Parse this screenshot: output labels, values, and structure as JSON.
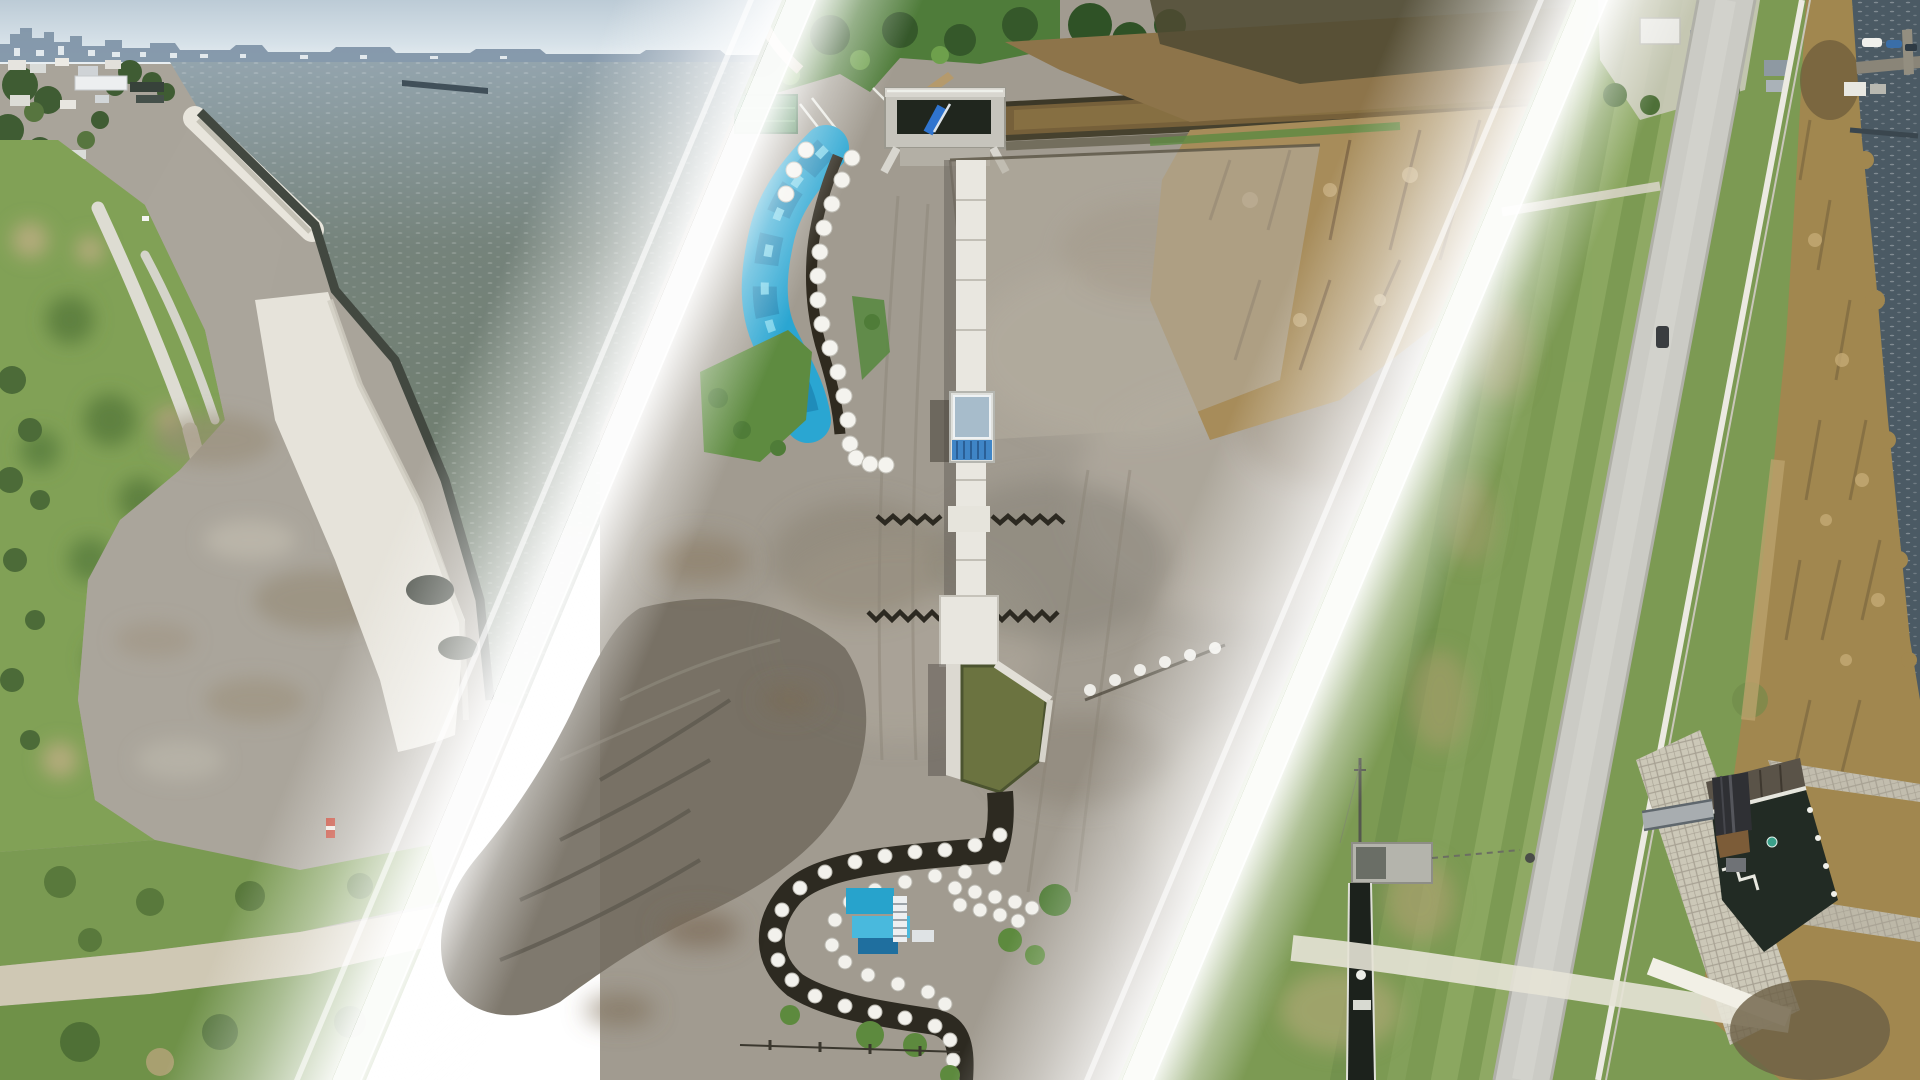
{
  "scene": {
    "type": "photo-collage",
    "title": "Aerial drone photo collage of lakeside levee and sluice construction sites",
    "no_visible_text": true,
    "layout": "three photographs separated by two parallel diagonal white gradient bands slanting toward bottom-left",
    "divider_color": "#ffffff"
  },
  "panels": {
    "left": {
      "label": "Oblique aerial photo: lakeshore levee with white riprap revetment, green farm fields and paths, town with trees, distant city skyline across gray-green water",
      "features": [
        "sky",
        "city-skyline",
        "lake-water",
        "breakwater",
        "shore-town",
        "trees",
        "green-fields",
        "farm-paths",
        "riprap-revetment",
        "gravel-works-area",
        "red-marker",
        "dirt-road",
        "bottom-grass"
      ],
      "palette": {
        "sky": "#c3d2da",
        "water": "#74816f",
        "skyline": "#7e93a6",
        "field": "#81a156",
        "revetment": "#e8e5dc",
        "gravel": "#a9a49a"
      }
    },
    "middle": {
      "label": "Top-down drone photo: drainage sluice construction site with concrete culvert, blue tarpaulin S-curve, white sandbag rows, concrete flume, stilling basin and spoil mound",
      "features": [
        "tree-line",
        "green-roof-shed",
        "concrete-culvert",
        "blue-pipe",
        "upstream-ditch",
        "reed-marsh",
        "cleared-pad",
        "blue-tarp-s-curve",
        "sandbag-rows",
        "concrete-flume",
        "gauge-house",
        "sheet-pile-rows",
        "stilling-basin",
        "dark-channel",
        "sandbag-c-curve",
        "work-tarps",
        "ladder",
        "spoil-mound",
        "grass-patches",
        "fence-line"
      ],
      "palette": {
        "dirt": "#a19b90",
        "tarp": "#2aa6d2",
        "sandbag": "#f3f2ec",
        "basin_water": "#6b7340",
        "reeds": "#a78c5a",
        "culvert_opening": "#20261e"
      }
    },
    "right": {
      "label": "Top-down aerial photo: river levee crest road with mowed grass, sluice gate building with footbridge, stone block revetment, reed marsh, boat dock and open water",
      "features": [
        "levee-road",
        "mowed-grass",
        "crest-wall",
        "reed-marsh",
        "open-water",
        "boat-dock",
        "boats",
        "waterside-buildings",
        "joining-trail",
        "car",
        "intake-mast",
        "intake-platform",
        "intake-channel",
        "sluice-building",
        "footbridge-walkway",
        "stone-revetment",
        "outlet-channel",
        "buoy",
        "white-stairs",
        "crossing-path"
      ],
      "palette": {
        "grass": "#7c9a53",
        "road": "#cbcbc5",
        "marsh": "#a1874f",
        "water": "#4b5a64",
        "roof": "#2f3034"
      }
    }
  },
  "dividers": [
    {
      "name": "divider-left",
      "angle_deg": -22.8,
      "core_top_x": 786,
      "core_bottom_x": 332,
      "style": "soft white fade-in, bright core line, fade-out"
    },
    {
      "name": "divider-right",
      "angle_deg": -22.8,
      "core_top_x": 1576,
      "core_bottom_x": 1122,
      "style": "soft white fade-in, bright core line, fade-out"
    }
  ]
}
